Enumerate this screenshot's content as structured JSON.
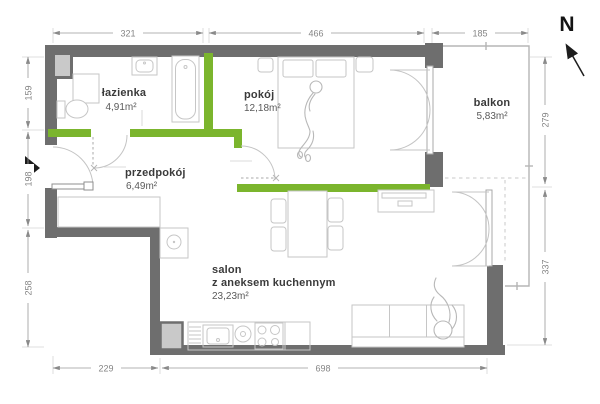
{
  "compass": {
    "label": "N"
  },
  "rooms": {
    "lazienka": {
      "name": "łazienka",
      "area": "4,91m²"
    },
    "pokoj": {
      "name": "pokój",
      "area": "12,18m²"
    },
    "przedpokoj": {
      "name": "przedpokój",
      "area": "6,49m²"
    },
    "salon": {
      "name": "salon",
      "subtitle": "z aneksem kuchennym",
      "area": "23,23m²"
    },
    "balkon": {
      "name": "balkon",
      "area": "5,83m²"
    }
  },
  "dimensions": {
    "top": [
      "321",
      "466",
      "185"
    ],
    "left": [
      "159",
      "198",
      "258"
    ],
    "right": [
      "279",
      "337"
    ],
    "bottom": [
      "229",
      "698"
    ]
  },
  "colors": {
    "exterior_wall": "#6e6e6e",
    "partition_wall": "#7bb52d",
    "furniture_line": "#c6c6c6",
    "dimension": "#8a8a8a"
  }
}
